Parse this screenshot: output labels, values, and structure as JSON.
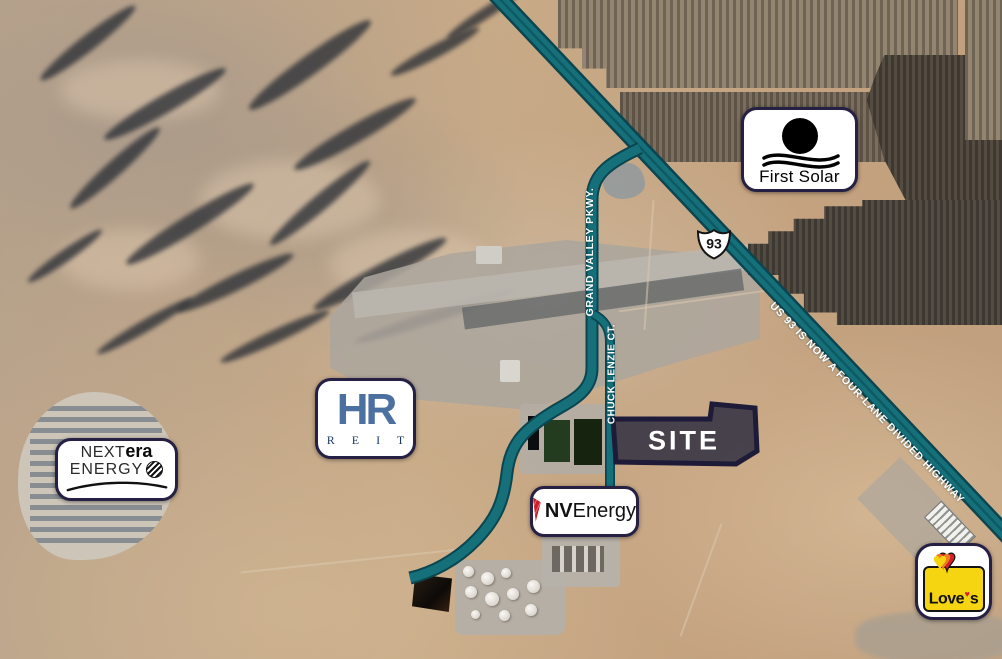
{
  "roads": {
    "grand_valley_label": "GRAND VALLEY PKWY.",
    "chuck_lenzie_label": "CHUCK LENZIE CT.",
    "us93_shield_number": "93",
    "us93_banner": "US 93 IS NOW A FOUR-LANE DIVIDED HIGHWAY"
  },
  "site": {
    "label": "SITE"
  },
  "signs": {
    "first_solar": {
      "name": "First Solar"
    },
    "hr_reit": {
      "monogram": "HR",
      "sub": "R E I T"
    },
    "nextera_energy": {
      "line1_thin": "NEXT",
      "line1_bold": "era",
      "line2": "ENERGY"
    },
    "nv_energy": {
      "bold": "NV",
      "regular": "Energy"
    },
    "loves": {
      "word": "Love",
      "s": "s"
    }
  },
  "icons": {
    "loves_heart": "♥"
  },
  "colors": {
    "road_fill": "#15707a",
    "road_edge": "#0b4550",
    "site_fill": "rgba(28,24,54,0.5)",
    "site_border": "#1e1b38",
    "sign_border": "#262144",
    "nv_red": "#c8202a",
    "loves_yellow": "#f5d511",
    "hr_blue": "#4c70a0",
    "desert_tan": "#c2a585"
  }
}
